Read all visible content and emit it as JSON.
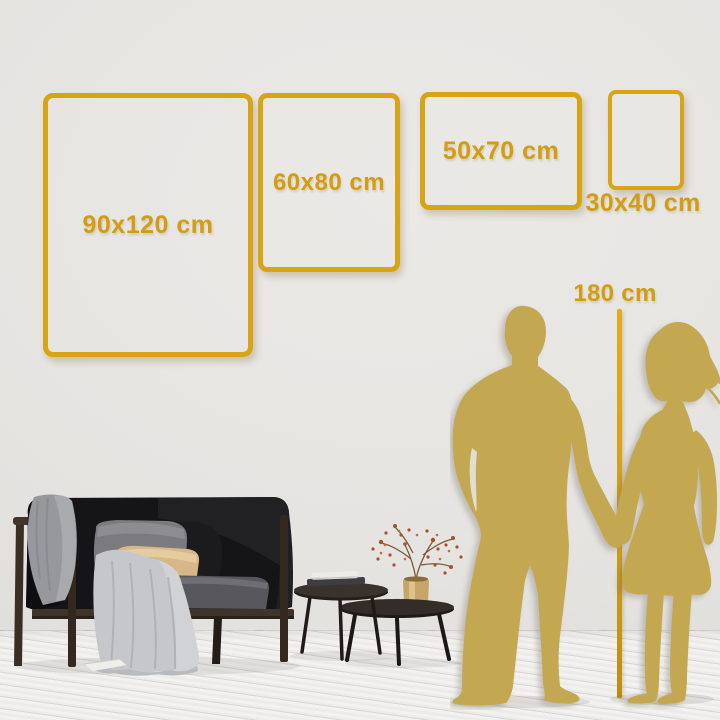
{
  "size_guide": {
    "frames": [
      {
        "id": "90x120",
        "label": "90x120 cm",
        "orientation": "portrait"
      },
      {
        "id": "60x80",
        "label": "60x80 cm",
        "orientation": "portrait"
      },
      {
        "id": "50x70",
        "label": "50x70 cm",
        "orientation": "landscape"
      },
      {
        "id": "30x40",
        "label": "30x40 cm",
        "orientation": "portrait"
      }
    ],
    "height_reference": {
      "label": "180 cm"
    }
  },
  "colors": {
    "accent_gold": "#D9A413",
    "label_gold": "#D29D12",
    "silhouette_gold": "#C4A851",
    "wall": "#E6E4E1",
    "floor": "#F3F2F0",
    "sofa_dark": "#151518"
  }
}
